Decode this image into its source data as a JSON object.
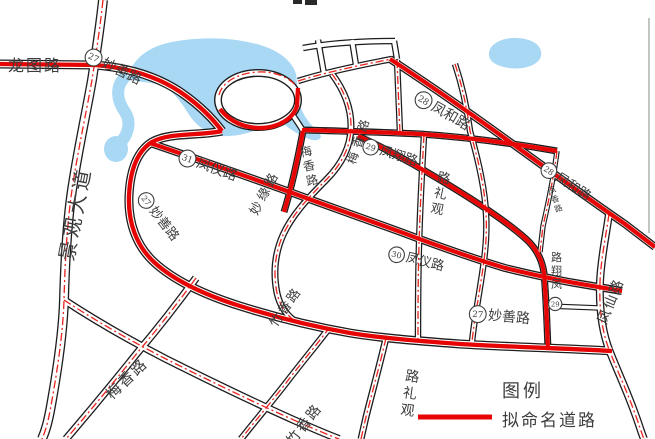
{
  "legend": {
    "title": "图例",
    "items": [
      {
        "label": "拟命名道路",
        "symbol": "red-line"
      }
    ]
  },
  "colors": {
    "named_road": "#e60404",
    "centerline": "#e8231d",
    "water": "#a9d8f4",
    "road_casing": "#1c1c1c",
    "label_text": "#3d3d3d"
  },
  "map_labels": [
    {
      "id": "label-longtu-road",
      "text": "龙图路",
      "x": 8,
      "y": 71,
      "size": 16,
      "rot": 0,
      "ls": 2
    },
    {
      "id": "label-miaoshan-road-27-top",
      "text": "妙善路",
      "badge": "27",
      "x": 84,
      "y": 58,
      "size": 14,
      "rot": 26
    },
    {
      "id": "label-fengyi-road-31",
      "text": "凤仪路",
      "badge": "31",
      "x": 178,
      "y": 160,
      "size": 14,
      "rot": 20
    },
    {
      "id": "label-miaoshan-road-27-west",
      "text": "妙善路",
      "badge": "27",
      "x": 138,
      "y": 197,
      "size": 13,
      "rot": 52
    },
    {
      "id": "label-miaoyuan-road",
      "text": "妙缘路",
      "x": 257,
      "y": 216,
      "size": 13,
      "rot": -62,
      "ls": 3
    },
    {
      "id": "label-meixiang-road-mid",
      "text": "梅香路",
      "x": 301,
      "y": 157,
      "size": 12,
      "rot": -12,
      "vert": "down"
    },
    {
      "id": "label-meixiang-road-upper",
      "text": "梅香路",
      "x": 355,
      "y": 165,
      "size": 12,
      "rot": -72,
      "ls": 5
    },
    {
      "id": "label-fenghe-road-28-west",
      "text": "凤和路",
      "badge": "28",
      "x": 414,
      "y": 100,
      "size": 14,
      "rot": 30
    },
    {
      "id": "label-fengxiang-road-29-west",
      "text": "凤翔路",
      "badge": "29",
      "x": 362,
      "y": 149,
      "size": 13,
      "rot": 17
    },
    {
      "id": "label-guanli-road-upper",
      "text": "观礼路",
      "x": 430,
      "y": 212,
      "size": 13,
      "rot": 12,
      "vert": "up"
    },
    {
      "id": "label-fenghe-road-28-east",
      "text": "凤和路",
      "badge": "28",
      "x": 540,
      "y": 170,
      "size": 13,
      "rot": 33
    },
    {
      "id": "label-fengxiang-road-small",
      "text": "凤香路",
      "x": 549,
      "y": 194,
      "size": 8,
      "rot": -20,
      "vert": "down"
    },
    {
      "id": "label-fengxiang-road-29-south",
      "text": "凤翔路",
      "badge": "29",
      "x": 551,
      "y": 288,
      "size": 11,
      "rot": 0,
      "vert": "up"
    },
    {
      "id": "label-fengxian-road",
      "text": "凤仙路",
      "x": 606,
      "y": 325,
      "size": 14,
      "rot": -68,
      "ls": 2
    },
    {
      "id": "label-fengyi-road-30",
      "text": "凤仪路",
      "badge": "30",
      "x": 388,
      "y": 257,
      "size": 13,
      "rot": 14
    },
    {
      "id": "label-miaoshan-road-27-south",
      "text": "妙善路",
      "badge": "27",
      "x": 469,
      "y": 318,
      "size": 14,
      "rot": 5
    },
    {
      "id": "label-zhuxiang-road",
      "text": "竹香路",
      "x": 276,
      "y": 328,
      "size": 13,
      "rot": -55,
      "ls": 2
    },
    {
      "id": "label-guanli-road-south",
      "text": "观礼路",
      "x": 400,
      "y": 414,
      "size": 14,
      "rot": 8,
      "vert": "up"
    },
    {
      "id": "label-meixiang-road-south",
      "text": "梅香路",
      "x": 112,
      "y": 400,
      "size": 15,
      "rot": -44,
      "ls": 2
    },
    {
      "id": "label-zhuxiang-road-south",
      "text": "竹香路",
      "x": 293,
      "y": 446,
      "size": 14,
      "rot": -52,
      "ls": 2
    },
    {
      "id": "label-jingguan-avenue",
      "text": "景观大道",
      "x": 73,
      "y": 262,
      "size": 20,
      "rot": -79,
      "ls": 4
    }
  ]
}
